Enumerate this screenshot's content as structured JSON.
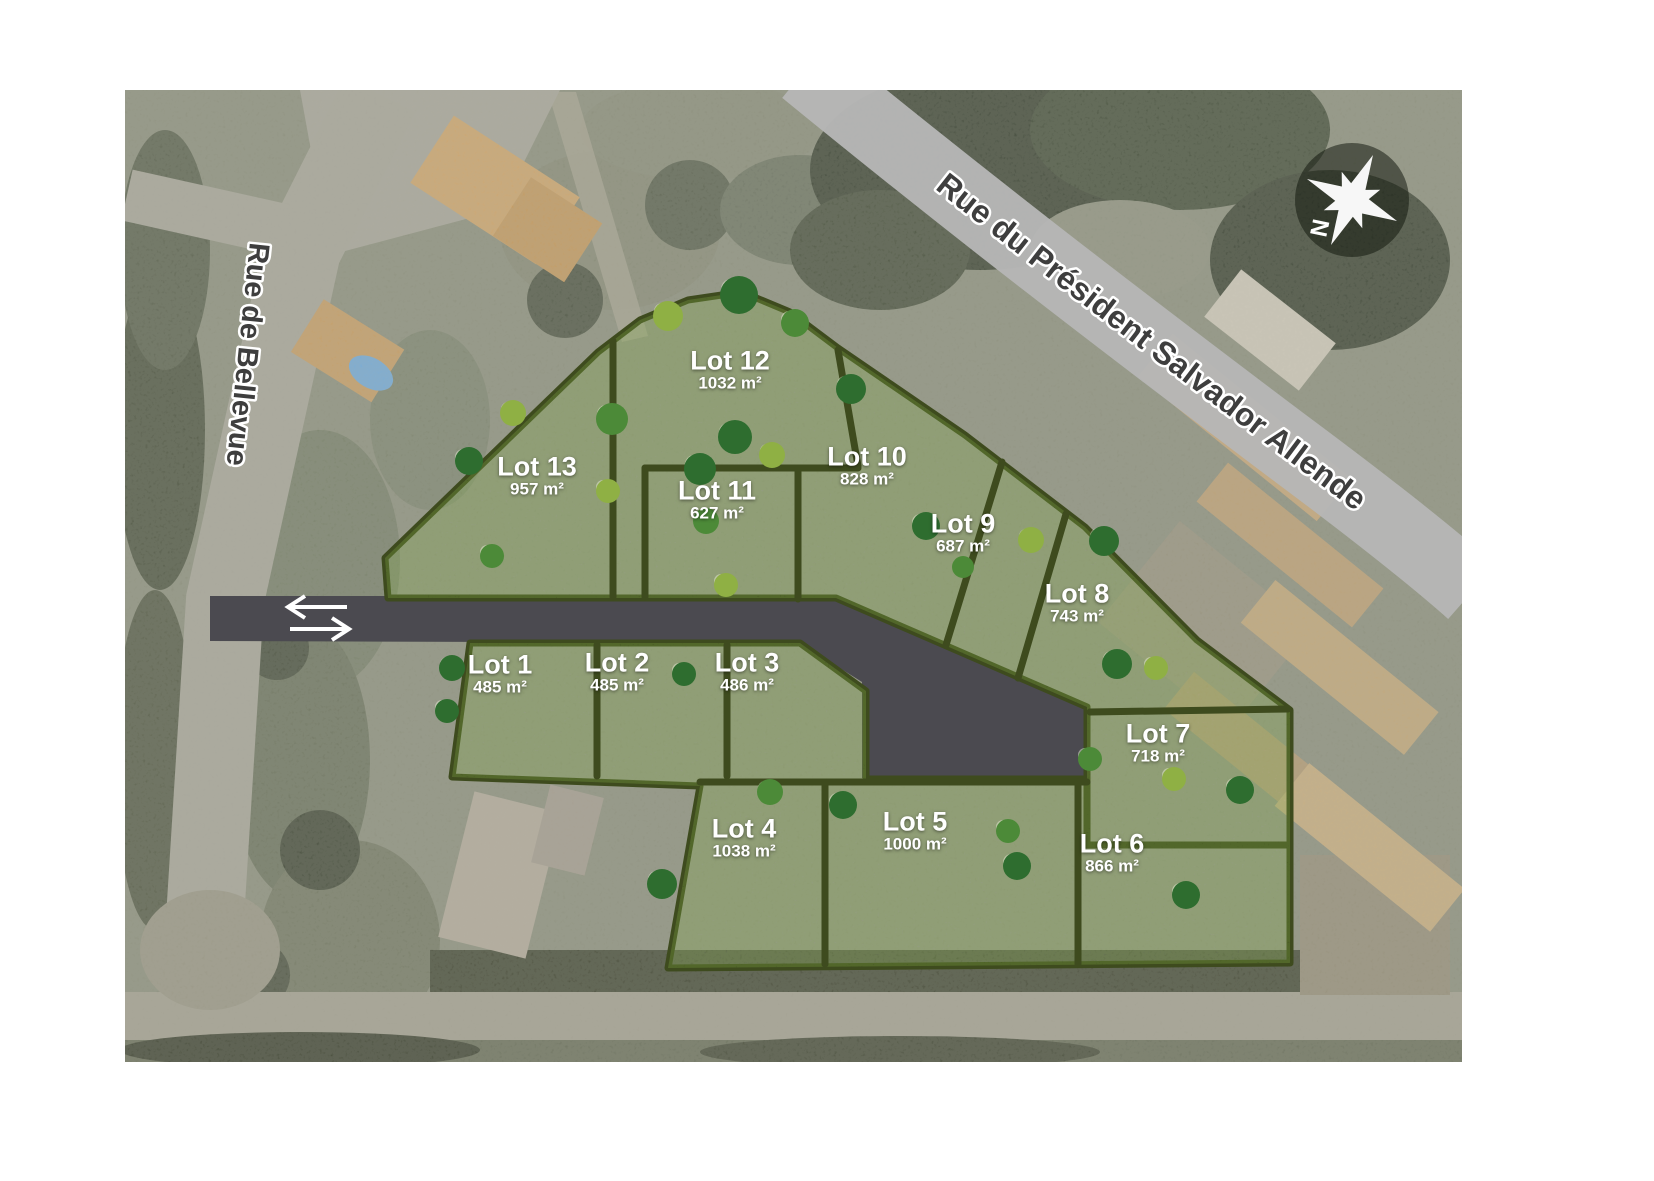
{
  "map": {
    "streets": {
      "bellevue": "Rue de Bellevue",
      "allende": "Rue du Président Salvador Allende"
    },
    "compass": {
      "north_label": "N"
    },
    "access_road": {
      "arrow_icon": "two-way-arrow"
    },
    "lots": [
      {
        "id": 1,
        "name": "Lot 1",
        "area": "485 m²"
      },
      {
        "id": 2,
        "name": "Lot 2",
        "area": "485 m²"
      },
      {
        "id": 3,
        "name": "Lot 3",
        "area": "486 m²"
      },
      {
        "id": 4,
        "name": "Lot 4",
        "area": "1038 m²"
      },
      {
        "id": 5,
        "name": "Lot 5",
        "area": "1000 m²"
      },
      {
        "id": 6,
        "name": "Lot 6",
        "area": "866 m²"
      },
      {
        "id": 7,
        "name": "Lot 7",
        "area": "718 m²"
      },
      {
        "id": 8,
        "name": "Lot 8",
        "area": "743 m²"
      },
      {
        "id": 9,
        "name": "Lot 9",
        "area": "687 m²"
      },
      {
        "id": 10,
        "name": "Lot 10",
        "area": "828 m²"
      },
      {
        "id": 11,
        "name": "Lot 11",
        "area": "627 m²"
      },
      {
        "id": 12,
        "name": "Lot 12",
        "area": "1032 m²"
      },
      {
        "id": 13,
        "name": "Lot 13",
        "area": "957 m²"
      }
    ],
    "colors": {
      "lot_green": "#81a238",
      "hedge": "#3e4b1e",
      "access_road": "#4b4a50",
      "road_overlay": "#b6b6b6",
      "street_label": "#3e3e3e",
      "lot_label": "#ffffff"
    }
  }
}
